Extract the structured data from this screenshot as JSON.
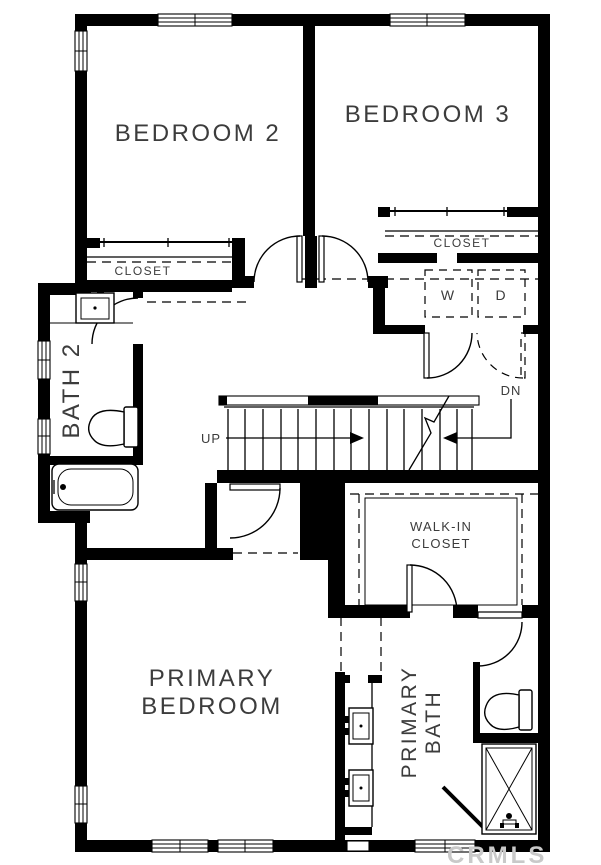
{
  "colors": {
    "wall": "#000000",
    "background": "#ffffff",
    "label": "#3c3c3c",
    "watermark": "#c9c9c9"
  },
  "labels": {
    "bedroom2": "BEDROOM 2",
    "bedroom3": "BEDROOM 3",
    "closet_bedroom2": "CLOSET",
    "closet_bedroom3": "CLOSET",
    "washer": "W",
    "dryer": "D",
    "bath2": "BATH 2",
    "stairs_up": "UP",
    "stairs_dn": "DN",
    "walk_in_line1": "WALK-IN",
    "walk_in_line2": "CLOSET",
    "primary_bedroom_line1": "PRIMARY",
    "primary_bedroom_line2": "BEDROOM",
    "primary_bath_line1": "PRIMARY",
    "primary_bath_line2": "BATH"
  },
  "watermark": {
    "text": "CRMLS"
  }
}
